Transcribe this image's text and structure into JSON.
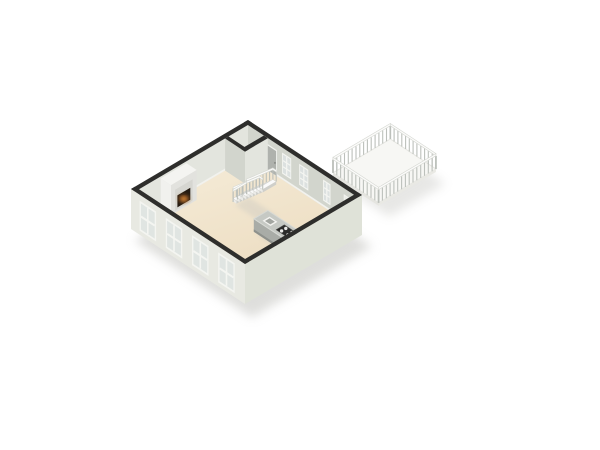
{
  "view": {
    "type": "3d-floor-plan-render",
    "projection": "isometric-birdseye",
    "background": "#ffffff"
  },
  "room": {
    "label": "open-plan living room with kitchen",
    "shape": "square",
    "wall_finish": "light plaster, dark cut-top band",
    "floor_finish": "beige"
  },
  "items": [
    {
      "name": "fireplace",
      "desc": "chimney breast with lit firebox",
      "wall": "back-left"
    },
    {
      "name": "corner-closet",
      "desc": "small closet at back corner"
    },
    {
      "name": "back-door",
      "desc": "grey door beside closet",
      "wall": "back-right"
    },
    {
      "name": "staircase",
      "desc": "straight white stair with balusters",
      "steps": 9
    },
    {
      "name": "kitchen-island",
      "desc": "grey island with 4-burner cooktop and sink"
    },
    {
      "name": "wall-counter",
      "desc": "white counter along right wall"
    },
    {
      "name": "terrace-door",
      "desc": "white door to terrace",
      "wall": "back-right"
    },
    {
      "name": "terrace",
      "desc": "attached deck enclosed by baluster railing"
    }
  ],
  "counts": {
    "facade_windows": 4,
    "back_wall_windows": 3,
    "stair_steps": 9,
    "cooktop_burners": 4,
    "railing_sides": 4
  },
  "colors": {
    "bg": "#ffffff",
    "wallTop": "#2e2e2c",
    "wallInnerL": "#e3e5de",
    "wallInnerR": "#d2d5cd",
    "facadeL": "#e8e9e2",
    "facadeR": "#dfe2d8",
    "baseboard": "#f2f2ee",
    "floorLight": "#f6edda",
    "floorDark": "#ecdcc0",
    "closetFloor": "#dadcd4",
    "fpFront": "#e2e2de",
    "fpSide": "#f1f1ee",
    "fpTop": "#f4f4f1",
    "fpPanel": "#d6d6d1",
    "firebox": "#241b12",
    "fireGlow": "#b06020",
    "fireCore": "#f0a64a",
    "tread": "#fafafa",
    "treadEdge": "#cfcfca",
    "stringer": "#ebebe8",
    "railPost": "#bcc0bb",
    "handRail": "#fbfbfa",
    "railEdge": "#d5d7d1",
    "islandTop": "#c6c9c4",
    "islandRim": "#d8dad5",
    "islandFront": "#a9aca7",
    "islandEnd": "#9fa29d",
    "islandBase": "#8e918c",
    "cooktop": "#2b2b2a",
    "burner": "#e9e9e7",
    "sinkOut": "#f3f3f0",
    "sinkIn": "#a3a6a1",
    "counterTop": "#f4f4f0",
    "counterFace": "#e6e7e1",
    "deckFloor": "#f7f7f4",
    "deckEdge": "#e5e5e0",
    "deckSkirt": "#e9e9e4",
    "doorGrey": "#afb2ad",
    "doorFrame": "#f1f2ee",
    "deckDoor": "#eaece6",
    "winFrame": "#f4f5f1",
    "glass": "#dce1e0",
    "glassOut": "#e0e5e2",
    "shadow": "#c4c4c0"
  }
}
